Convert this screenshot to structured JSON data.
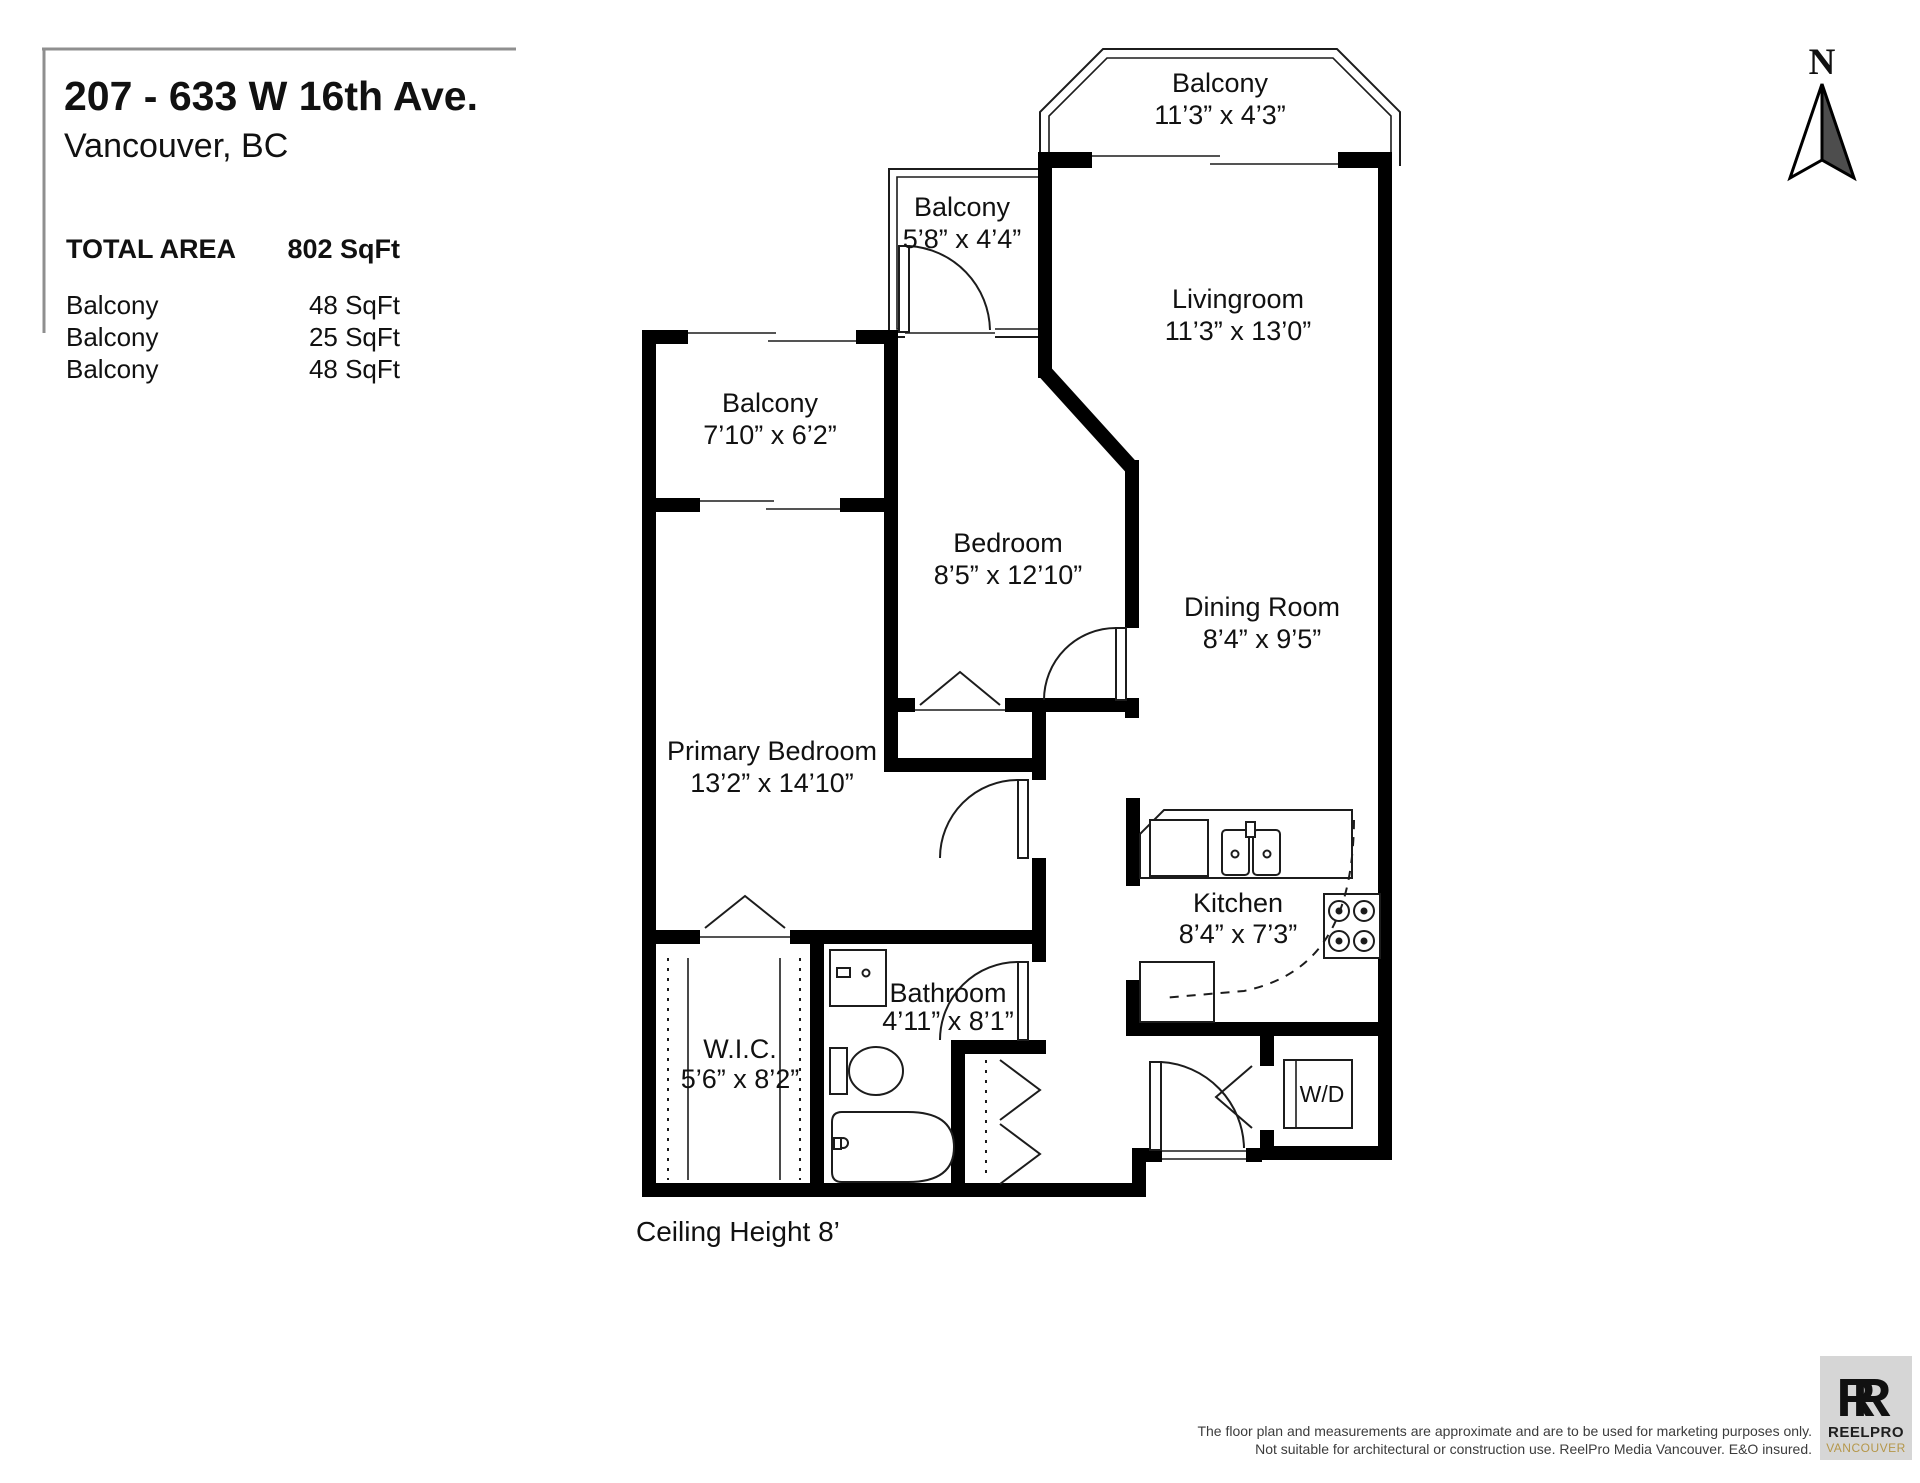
{
  "header": {
    "address_line1": "207 - 633 W 16th Ave.",
    "address_line2": "Vancouver, BC"
  },
  "area_table": {
    "total_label": "TOTAL AREA",
    "total_value": "802 SqFt",
    "rows": [
      {
        "label": "Balcony",
        "value": "48 SqFt"
      },
      {
        "label": "Balcony",
        "value": "25 SqFt"
      },
      {
        "label": "Balcony",
        "value": "48 SqFt"
      }
    ]
  },
  "rooms": {
    "balcony_top": {
      "name": "Balcony",
      "dims": "11’3” x 4’3”"
    },
    "balcony_upper": {
      "name": "Balcony",
      "dims": "5’8” x 4’4”"
    },
    "balcony_west": {
      "name": "Balcony",
      "dims": "7’10” x 6’2”"
    },
    "livingroom": {
      "name": "Livingroom",
      "dims": "11’3” x 13’0”"
    },
    "bedroom": {
      "name": "Bedroom",
      "dims": "8’5” x 12’10”"
    },
    "dining_room": {
      "name": "Dining Room",
      "dims": "8’4” x 9’5”"
    },
    "primary_bedroom": {
      "name": "Primary Bedroom",
      "dims": "13’2” x 14’10”"
    },
    "kitchen": {
      "name": "Kitchen",
      "dims": "8’4” x 7’3”"
    },
    "wic": {
      "name": "W.I.C.",
      "dims": "5’6” x 8’2”"
    },
    "bathroom": {
      "name": "Bathroom",
      "dims": "4’11” x 8’1”"
    },
    "washer_dryer": {
      "label": "W/D"
    }
  },
  "notes": {
    "ceiling": "Ceiling Height 8’"
  },
  "compass": {
    "label": "N"
  },
  "footer": {
    "disclaimer_line1": "The floor plan and measurements are approximate and are to be used for marketing purposes only.",
    "disclaimer_line2": "Not suitable for architectural or construction use. ReelPro Media Vancouver. E&O insured.",
    "logo_monogram": "R",
    "logo_line1": "REELPRO",
    "logo_line2": "VANCOUVER"
  },
  "colors": {
    "wall": "#000000",
    "line": "#1c1c1c",
    "accent_gold": "#b5974a",
    "logo_bg": "#d6d6d6",
    "text": "#111111"
  }
}
